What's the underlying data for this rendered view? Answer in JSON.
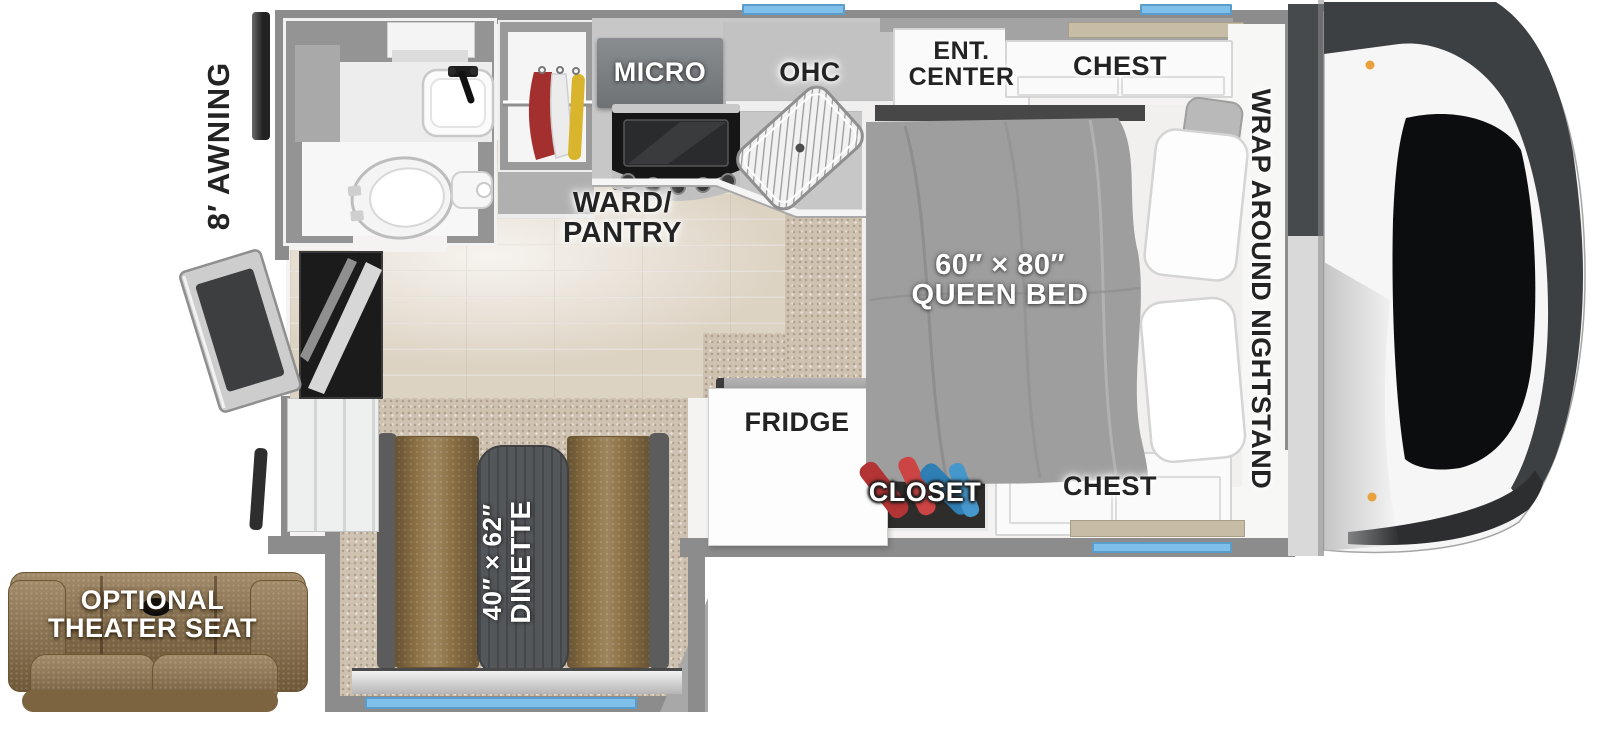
{
  "floorplan": {
    "description": "Top-down RV truck camper floor plan",
    "exterior": {
      "awning_label": "8′ AWNING"
    },
    "kitchen": {
      "micro_label": "MICRO",
      "ohc_label": "OHC",
      "ward_pantry_line1": "WARD/",
      "ward_pantry_line2": "PANTRY",
      "fridge_label": "FRIDGE"
    },
    "bedroom": {
      "ent_center_line1": "ENT.",
      "ent_center_line2": "CENTER",
      "chest_top_label": "CHEST",
      "chest_bottom_label": "CHEST",
      "closet_label": "CLOSET",
      "nightstand_label": "WRAP AROUND NIGHTSTAND",
      "bed_size_label": "60″ × 80″",
      "bed_type_label": "QUEEN BED"
    },
    "dinette": {
      "size_label": "40″ × 62″",
      "name_label": "DINETTE"
    },
    "options": {
      "theater_line1": "OPTIONAL",
      "theater_line2": "THEATER SEAT"
    },
    "colors": {
      "window_blue": "#7fc0ea",
      "accent_blue": "#2b4d9e",
      "wall_gray": "#8c8c8c",
      "wood_floor": "#ddd3c3",
      "carpet_tan": "#cfc2b1",
      "upholstery_brown": "#8e7246",
      "bedding_gray": "#9e9e9e",
      "trim_tan": "#c7bda7"
    }
  }
}
